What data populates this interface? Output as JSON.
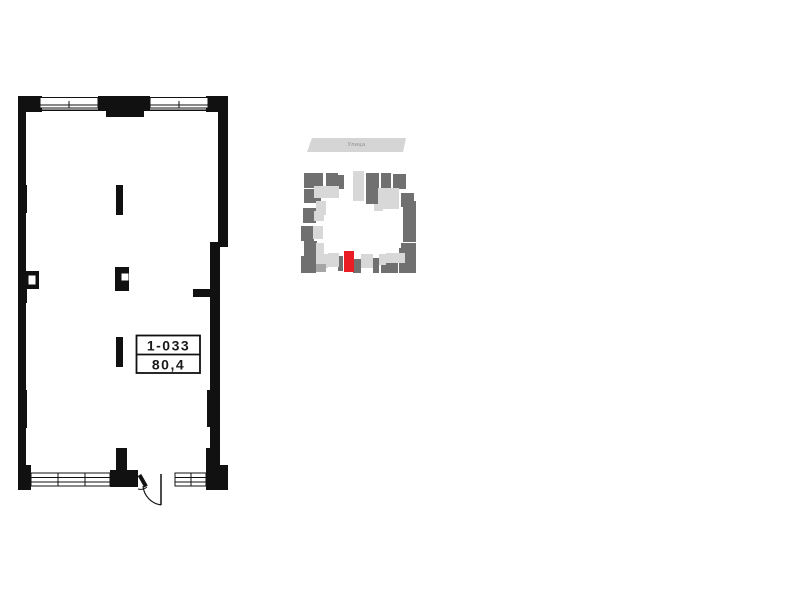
{
  "unit": {
    "number": "1-033",
    "area": "80,4"
  },
  "minimap": {
    "street_label": "Улица"
  },
  "colors": {
    "wall_black": "#111111",
    "minimap_dark": "#707070",
    "minimap_mid": "#a6a6a6",
    "minimap_light": "#d8d8d8",
    "minimap_red": "#ea1c24",
    "banner_bg": "#d5d5d5",
    "banner_text": "#8c8c8c"
  }
}
